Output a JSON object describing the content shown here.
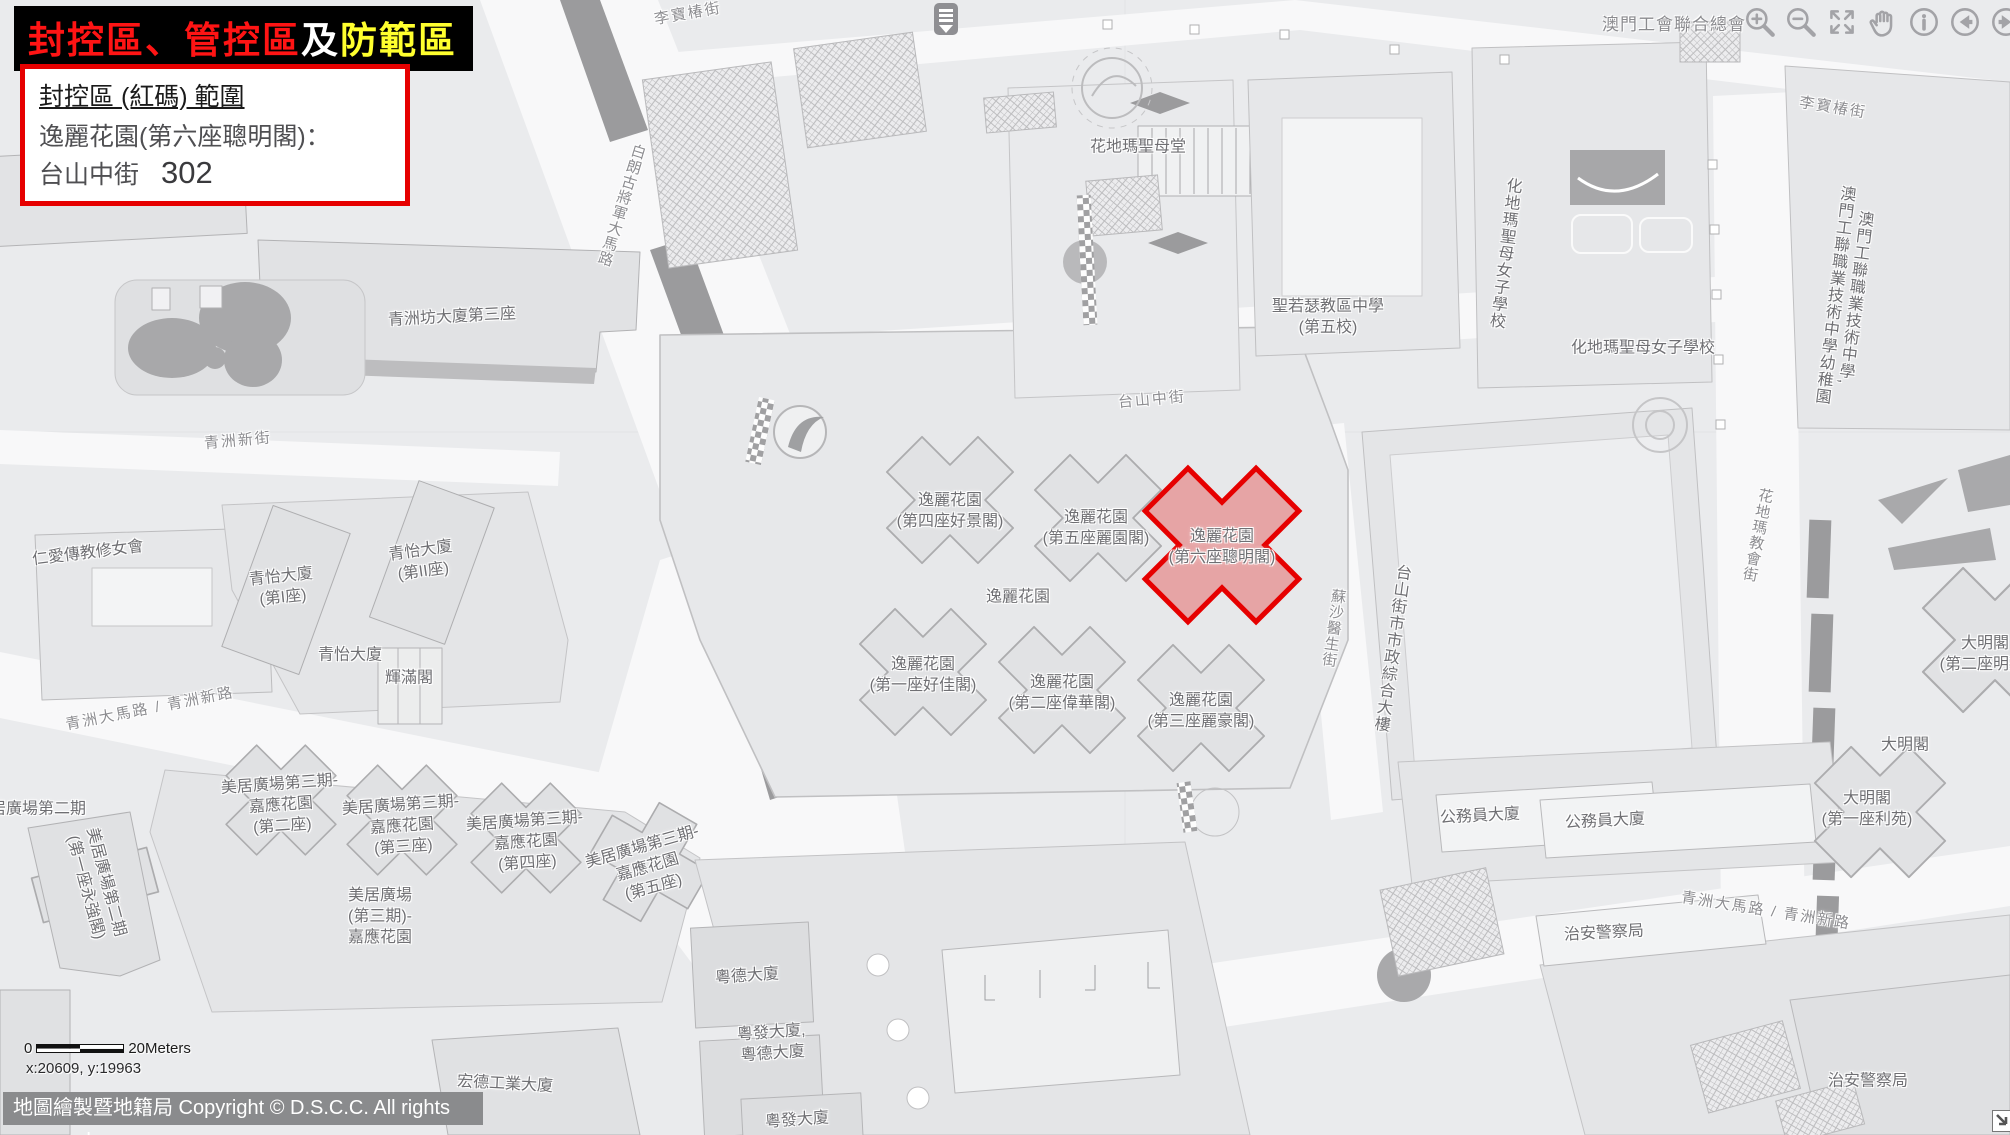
{
  "banner": {
    "part1": "封控區、管控區",
    "part2": "及",
    "part3": "防範區",
    "color1": "#ff1414",
    "color2": "#ffffff",
    "color3": "#ffff2e",
    "background": "#000000"
  },
  "info_box": {
    "heading": "封控區 (紅碼) 範圍",
    "building_line": "逸麗花園(第六座聰明閣)：",
    "street": "台山中街",
    "number": "302",
    "border_color": "#e60000"
  },
  "highlight_zone": {
    "name": "逸麗花園(第六座聰明閣)",
    "outline_color": "#e60000",
    "fill_color": "rgba(229,96,96,0.5)"
  },
  "toolbar": {
    "org_label": "澳門工會聯合總會",
    "icons": [
      "zoom-in",
      "zoom-out",
      "full-extent",
      "pan",
      "info",
      "previous",
      "next"
    ]
  },
  "scale_bar": {
    "zero": "0",
    "distance": "20Meters"
  },
  "coords": {
    "text": "x:20609, y:19963"
  },
  "attribution": {
    "text": "地圖繪製暨地籍局 Copyright © D.S.C.C. All rights reserved"
  },
  "corner_widget": {
    "icon": "resize-arrow"
  },
  "marker": {
    "icon": "layers-marker"
  },
  "map": {
    "labels": [
      {
        "kind": "street",
        "text": "李寶椿街",
        "x": 688,
        "y": 14,
        "rot": -10
      },
      {
        "kind": "street",
        "text": "李寶椿街",
        "x": 1833,
        "y": 108,
        "rot": 9
      },
      {
        "kind": "street",
        "text": "白朗古將軍大馬路",
        "x": 621,
        "y": 205,
        "rot": 17,
        "vert": true
      },
      {
        "kind": "street",
        "text": "青洲新街",
        "x": 238,
        "y": 441,
        "rot": -5
      },
      {
        "kind": "street",
        "text": "台山中街",
        "x": 1152,
        "y": 400,
        "rot": -5
      },
      {
        "kind": "street",
        "text": "青洲大馬路 / 青洲新路",
        "x": 150,
        "y": 709,
        "rot": -11
      },
      {
        "kind": "street",
        "text": "青洲大馬路 / 青洲新路",
        "x": 1766,
        "y": 911,
        "rot": 9
      },
      {
        "kind": "street",
        "text": "蘇沙醫生街",
        "x": 1333,
        "y": 628,
        "rot": 8,
        "vert": true
      },
      {
        "kind": "street",
        "text": "花地瑪教會街",
        "x": 1757,
        "y": 535,
        "rot": 11,
        "vert": true
      },
      {
        "kind": "building",
        "text": "青洲坊大廈第三座",
        "x": 452,
        "y": 318,
        "rot": -3
      },
      {
        "kind": "building",
        "text": "花地瑪聖母堂",
        "x": 1138,
        "y": 148
      },
      {
        "kind": "building",
        "text": "聖若瑟教區中學\n(第五校)",
        "x": 1328,
        "y": 318
      },
      {
        "kind": "building",
        "text": "化地瑪聖母女子學校",
        "x": 1503,
        "y": 253,
        "vert": true,
        "rot": 7
      },
      {
        "kind": "building",
        "text": "化地瑪聖母女子學校",
        "x": 1643,
        "y": 349
      },
      {
        "kind": "building",
        "text": "澳門工聯職業技術中學,\n澳門工聯職業技術中學幼稚園",
        "x": 1843,
        "y": 296,
        "vert": true,
        "rot": 7
      },
      {
        "kind": "building",
        "text": "仁愛傳教修女會",
        "x": 88,
        "y": 554,
        "rot": -7
      },
      {
        "kind": "building",
        "text": "青怡大廈\n(第I座)",
        "x": 282,
        "y": 588,
        "rot": -6
      },
      {
        "kind": "building",
        "text": "青怡大廈\n(第II座)",
        "x": 422,
        "y": 562,
        "rot": -8
      },
      {
        "kind": "building",
        "text": "青怡大廈",
        "x": 350,
        "y": 656
      },
      {
        "kind": "building",
        "text": "輝滿閣",
        "x": 409,
        "y": 679
      },
      {
        "kind": "building",
        "text": "逸麗花園\n(第四座好景閣)",
        "x": 950,
        "y": 512
      },
      {
        "kind": "building",
        "text": "逸麗花園\n(第五座麗園閣)",
        "x": 1096,
        "y": 529
      },
      {
        "kind": "building",
        "text": "逸麗花園\n(第六座聰明閣)",
        "x": 1222,
        "y": 548
      },
      {
        "kind": "building",
        "text": "逸麗花園",
        "x": 1018,
        "y": 598
      },
      {
        "kind": "building",
        "text": "逸麗花園\n(第一座好佳閣)",
        "x": 923,
        "y": 676
      },
      {
        "kind": "building",
        "text": "逸麗花園\n(第二座偉華閣)",
        "x": 1062,
        "y": 694
      },
      {
        "kind": "building",
        "text": "逸麗花園\n(第三座麗豪閣)",
        "x": 1201,
        "y": 712
      },
      {
        "kind": "building",
        "text": "台山街市市政綜合大樓",
        "x": 1390,
        "y": 648,
        "vert": true,
        "rot": 8
      },
      {
        "kind": "building",
        "text": "美居廣場第二期",
        "x": 30,
        "y": 810
      },
      {
        "kind": "building",
        "text": "美居廣場第二期\n(第一座永強閣)",
        "x": 95,
        "y": 885,
        "rot": 75
      },
      {
        "kind": "building",
        "text": "美居廣場第三期-\n嘉應花園\n(第二座)",
        "x": 281,
        "y": 806,
        "rot": -4
      },
      {
        "kind": "building",
        "text": "美居廣場第三期-\n嘉應花園\n(第三座)",
        "x": 402,
        "y": 827,
        "rot": -4
      },
      {
        "kind": "building",
        "text": "美居廣場第三期-\n嘉應花園\n(第四座)",
        "x": 526,
        "y": 843,
        "rot": -4
      },
      {
        "kind": "building",
        "text": "美居廣場第三期-\n嘉應花園\n(第五座)",
        "x": 648,
        "y": 868,
        "rot": -16
      },
      {
        "kind": "building",
        "text": "美居廣場\n(第三期)-\n嘉應花園",
        "x": 380,
        "y": 917
      },
      {
        "kind": "building",
        "text": "公務員大廈",
        "x": 1480,
        "y": 817,
        "rot": -3
      },
      {
        "kind": "building",
        "text": "公務員大廈",
        "x": 1605,
        "y": 822,
        "rot": -3
      },
      {
        "kind": "building",
        "text": "治安警察局",
        "x": 1604,
        "y": 934,
        "rot": -3
      },
      {
        "kind": "building",
        "text": "治安警察局",
        "x": 1868,
        "y": 1082
      },
      {
        "kind": "building",
        "text": "大明閣\n(第二座明苑)",
        "x": 1985,
        "y": 655
      },
      {
        "kind": "building",
        "text": "大明閣",
        "x": 1905,
        "y": 746
      },
      {
        "kind": "building",
        "text": "大明閣\n(第一座利苑)",
        "x": 1867,
        "y": 810
      },
      {
        "kind": "building",
        "text": "粵德大廈",
        "x": 747,
        "y": 977,
        "rot": -4
      },
      {
        "kind": "building",
        "text": "粵發大廈,\n粵德大廈",
        "x": 772,
        "y": 1044,
        "rot": -4
      },
      {
        "kind": "building",
        "text": "粵發大廈",
        "x": 797,
        "y": 1121,
        "rot": -4
      },
      {
        "kind": "building",
        "text": "宏德工業大廈",
        "x": 505,
        "y": 1085,
        "rot": 3
      }
    ]
  }
}
